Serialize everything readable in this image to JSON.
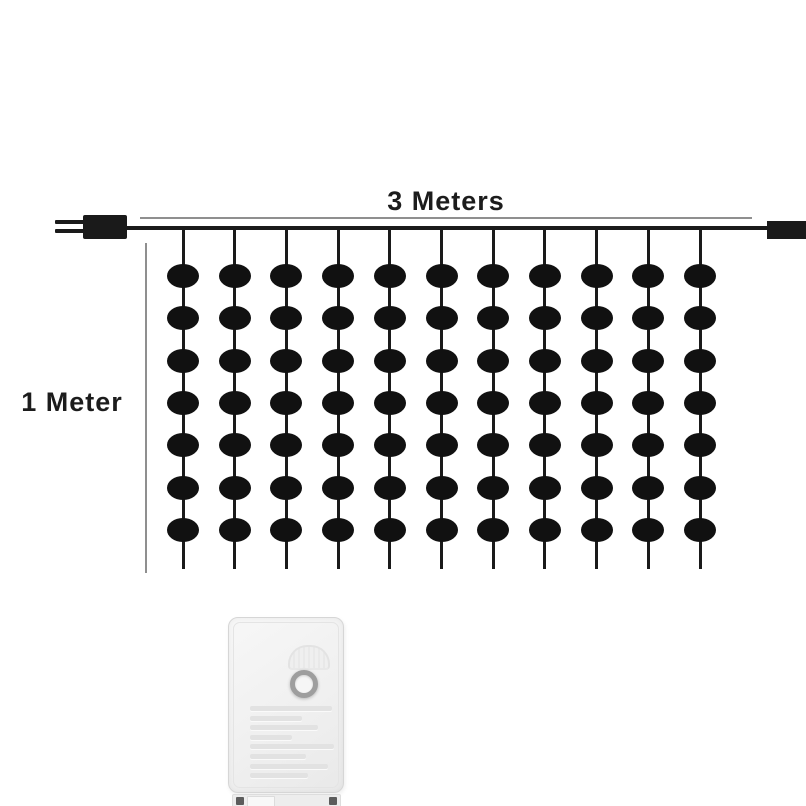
{
  "page": {
    "background": "#ffffff"
  },
  "diagram": {
    "width_label": "3 Meters",
    "height_label": "1 Meter",
    "strings_count": 11,
    "bulbs_per_string": 7,
    "colors": {
      "wire": "#1a1a1a",
      "bulb": "#111111",
      "measure_line": "#8f8f8f",
      "label_text": "#1c1c1c"
    },
    "icons": [
      "power-plug-icon",
      "end-connector-icon",
      "led-bulb"
    ]
  },
  "controller": {
    "body_color": "#f2f2f2",
    "border_color": "#d6d6d6",
    "button_ring_color": "#9e9e9e",
    "embossed_line_count": 8,
    "icons": [
      "mode-button-icon",
      "emblem-icon",
      "screw-icon"
    ]
  }
}
